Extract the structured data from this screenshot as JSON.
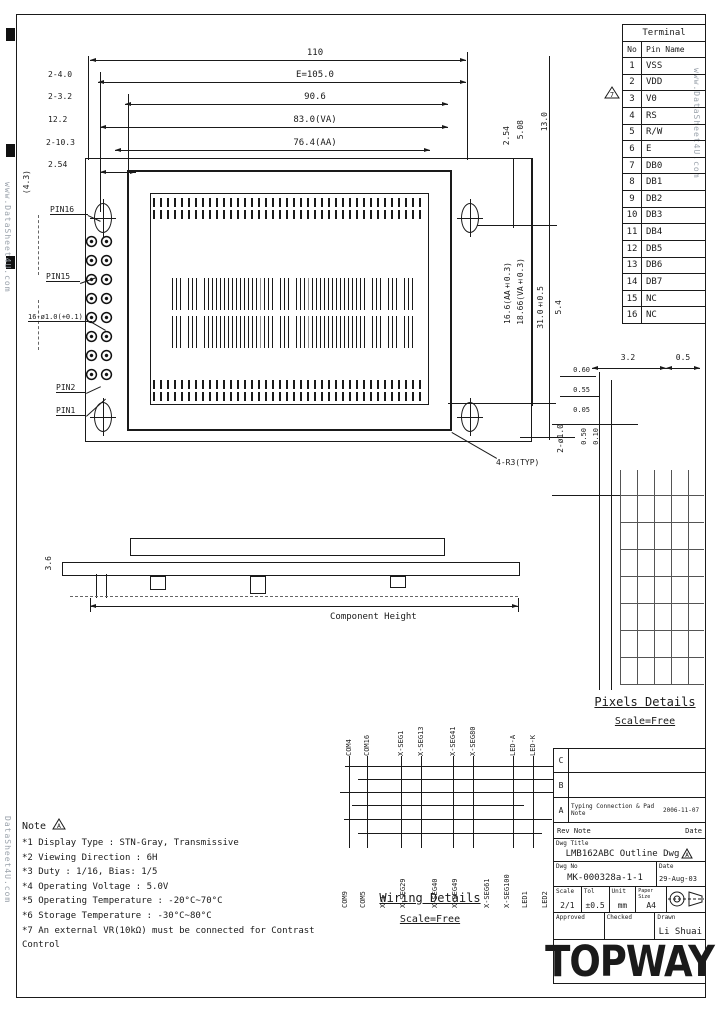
{
  "sheet": {
    "watermark_right": "www.DataSheet4U.com",
    "watermark_left": "www.DataSheet4U.com",
    "watermark_bottom_left": "DataSheet4U.com"
  },
  "terminal_table": {
    "title": "Terminal",
    "col_no": "No",
    "col_name": "Pin Name",
    "note_ref": "7",
    "rows": [
      [
        "1",
        "VSS"
      ],
      [
        "2",
        "VDD"
      ],
      [
        "3",
        "V0"
      ],
      [
        "4",
        "RS"
      ],
      [
        "5",
        "R/W"
      ],
      [
        "6",
        "E"
      ],
      [
        "7",
        "DB0"
      ],
      [
        "8",
        "DB1"
      ],
      [
        "9",
        "DB2"
      ],
      [
        "10",
        "DB3"
      ],
      [
        "11",
        "DB4"
      ],
      [
        "12",
        "DB5"
      ],
      [
        "13",
        "DB6"
      ],
      [
        "14",
        "DB7"
      ],
      [
        "15",
        "NC"
      ],
      [
        "16",
        "NC"
      ]
    ]
  },
  "top_dims": {
    "rows": [
      {
        "label": "",
        "value": "110"
      },
      {
        "label": "2-4.0",
        "value": "E=105.0"
      },
      {
        "label": "2-3.2",
        "value": "90.6"
      },
      {
        "label": "12.2",
        "value": "83.0(VA)"
      },
      {
        "label": "2-10.3",
        "value": "76.4(AA)"
      },
      {
        "label": "2.54",
        "value": ""
      }
    ]
  },
  "front_view": {
    "labels": {
      "pin16": "PIN16",
      "pin15": "PIN15",
      "pin_holes": "16-ø1.0(+0.1)",
      "pin2": "PIN2",
      "pin1": "PIN1",
      "corner_radius": "4-R3(TYP)",
      "edge_dim": "(4.3)"
    }
  },
  "right_dims": {
    "d1": "2.54",
    "d2": "5.08",
    "d3": "13.0",
    "d4": "16.6(AA±0.3)",
    "d5": "18.66(VA±0.3)",
    "d6": "31.0±0.5",
    "d7": "5.4",
    "d8": "2-ø1.0"
  },
  "side_view": {
    "component_height": "Component Height",
    "thickness": "3.6"
  },
  "pixels_details": {
    "title": "Pixels Details",
    "scale": "Scale=Free",
    "dim_h1": "3.2",
    "dim_h2": "0.5",
    "dim_v1": "0.60",
    "dim_v2": "0.55",
    "dim_v3": "0.05",
    "dim_r1": "0.50",
    "dim_r2": "0.10"
  },
  "wiring_details": {
    "title": "Wiring Details",
    "scale": "Scale=Free",
    "top_labels": [
      "COM4",
      "COM16",
      "X-SEG1",
      "X-SEG13",
      "X-SEG41",
      "X-SEG80",
      "LED-A",
      "LED-K"
    ],
    "bottom_labels": [
      "COM9",
      "COM5",
      "X-1",
      "X-SEG29",
      "X-SEG40",
      "X-SEG49",
      "X-SEG61",
      "X-SEG100",
      "LED1",
      "LED2"
    ]
  },
  "notes": {
    "heading": "Note",
    "note_ref": "A",
    "items": [
      "*1 Display Type : STN-Gray, Transmissive",
      "*2 Viewing Direction : 6H",
      "*3 Duty : 1/16, Bias: 1/5",
      "*4 Operating Voltage : 5.0V",
      "*5 Operating Temperature : -20°C~70°C",
      "*6 Storage Temperature : -30°C~80°C",
      "*7 An external VR(10kΩ) must be connected for Contrast Control"
    ]
  },
  "title_block": {
    "revisions": [
      {
        "rev": "C",
        "note": "",
        "date": ""
      },
      {
        "rev": "B",
        "note": "",
        "date": ""
      },
      {
        "rev": "A",
        "note": "Typing Connection & Pad Note",
        "date": "2006-11-07"
      }
    ],
    "rev_header": {
      "note": "Rev Note",
      "date": "Date"
    },
    "dwg_title_label": "Dwg Title",
    "dwg_title": "LMB162ABC Outline Dwg",
    "dwg_title_rev": "A",
    "dwg_no_label": "Dwg No",
    "dwg_no": "MK-000328a-1-1",
    "date_label": "Date",
    "date": "29-Aug-03",
    "scale_label": "Scale",
    "scale": "2/1",
    "tol_label": "Tol",
    "tol": "±0.5",
    "unit_label": "Unit",
    "unit": "mm",
    "paper_label": "Paper Size",
    "paper": "A4",
    "approved_label": "Approved",
    "checked_label": "Checked",
    "drawn_label": "Drawn",
    "drawn": "Li Shuai",
    "logo": "TOPWAY"
  }
}
